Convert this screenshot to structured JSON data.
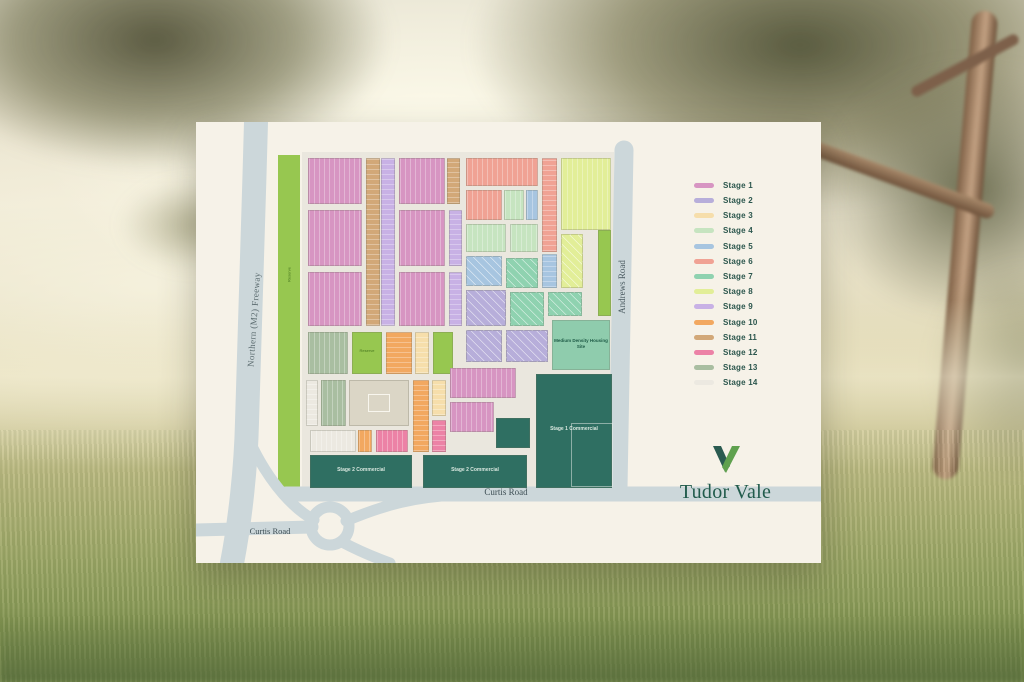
{
  "legend": {
    "items": [
      {
        "key": "s1",
        "label": "Stage 1",
        "color": "#D795C2"
      },
      {
        "key": "s2",
        "label": "Stage 2",
        "color": "#B7AEDA"
      },
      {
        "key": "s3",
        "label": "Stage 3",
        "color": "#F6DEAB"
      },
      {
        "key": "s4",
        "label": "Stage 4",
        "color": "#C6E4C0"
      },
      {
        "key": "s5",
        "label": "Stage 5",
        "color": "#A7C5E0"
      },
      {
        "key": "s6",
        "label": "Stage 6",
        "color": "#F0A294"
      },
      {
        "key": "s7",
        "label": "Stage 7",
        "color": "#8FD2B0"
      },
      {
        "key": "s8",
        "label": "Stage 8",
        "color": "#E2EE98"
      },
      {
        "key": "s9",
        "label": "Stage 9",
        "color": "#C8B1E5"
      },
      {
        "key": "s10",
        "label": "Stage 10",
        "color": "#F2A860"
      },
      {
        "key": "s11",
        "label": "Stage 11",
        "color": "#D2A878"
      },
      {
        "key": "s12",
        "label": "Stage 12",
        "color": "#EC82A6"
      },
      {
        "key": "s13",
        "label": "Stage 13",
        "color": "#A9BEA1"
      },
      {
        "key": "s14",
        "label": "Stage 14",
        "color": "#ECE9E1"
      }
    ]
  },
  "logo": {
    "wordmark": "Tudor Vale",
    "icon_dark": "#2A5B50",
    "icon_green": "#5FA14E"
  },
  "map": {
    "labels": {
      "freeway": "Northern (M2) Freeway",
      "andrews": "Andrews Road",
      "curtis": "Curtis Road",
      "curtis_west": "Curtis Road",
      "reserve": "Reserve",
      "reserve_2": "Reserve",
      "medium_density": "Medium Density Housing Site",
      "stage1_commercial": "Stage 1 Commercial",
      "stage2_commercial_a": "Stage 2 Commercial",
      "stage2_commercial_b": "Stage 2 Commercial"
    },
    "palette": {
      "s1": "#D795C2",
      "s2": "#B7AEDA",
      "s3": "#F6DEAB",
      "s4": "#C6E4C0",
      "s5": "#A7C5E0",
      "s6": "#F0A294",
      "s7": "#8FD2B0",
      "s8": "#E2EE98",
      "s9": "#C8B1E5",
      "s10": "#F2A860",
      "s11": "#D2A878",
      "s12": "#EC82A6",
      "s13": "#A9BEA1",
      "s14": "#ECE9E1",
      "park": "#97C750",
      "comm": "#2F6F62",
      "md": "#8FCCAD",
      "bldg": "#DBD6C6",
      "road": "#CCD7DA",
      "inner_road": "#EAE7DE",
      "card": "#F6F2E8"
    },
    "blocks": [
      {
        "s": "s1",
        "x": 112,
        "y": 36,
        "w": 54,
        "h": 46,
        "d": "v"
      },
      {
        "s": "s1",
        "x": 112,
        "y": 88,
        "w": 54,
        "h": 56,
        "d": "v"
      },
      {
        "s": "s1",
        "x": 112,
        "y": 150,
        "w": 54,
        "h": 54,
        "d": "v"
      },
      {
        "s": "s11",
        "x": 170,
        "y": 36,
        "w": 14,
        "h": 168,
        "d": "h"
      },
      {
        "s": "s9",
        "x": 185,
        "y": 36,
        "w": 14,
        "h": 168,
        "d": "h"
      },
      {
        "s": "s1",
        "x": 203,
        "y": 36,
        "w": 46,
        "h": 46,
        "d": "v"
      },
      {
        "s": "s11",
        "x": 251,
        "y": 36,
        "w": 13,
        "h": 46,
        "d": "h"
      },
      {
        "s": "s1",
        "x": 203,
        "y": 88,
        "w": 46,
        "h": 56,
        "d": "v"
      },
      {
        "s": "s1",
        "x": 203,
        "y": 150,
        "w": 46,
        "h": 54,
        "d": "v"
      },
      {
        "s": "s9",
        "x": 253,
        "y": 88,
        "w": 13,
        "h": 56,
        "d": "h"
      },
      {
        "s": "s9",
        "x": 253,
        "y": 150,
        "w": 13,
        "h": 54,
        "d": "h"
      },
      {
        "s": "s6",
        "x": 270,
        "y": 36,
        "w": 72,
        "h": 28,
        "d": "v"
      },
      {
        "s": "s6",
        "x": 270,
        "y": 68,
        "w": 36,
        "h": 30,
        "d": "v"
      },
      {
        "s": "s4",
        "x": 308,
        "y": 68,
        "w": 20,
        "h": 30,
        "d": "v"
      },
      {
        "s": "s5",
        "x": 330,
        "y": 68,
        "w": 12,
        "h": 30,
        "d": "v"
      },
      {
        "s": "s4",
        "x": 270,
        "y": 102,
        "w": 40,
        "h": 28,
        "d": "v"
      },
      {
        "s": "s4",
        "x": 314,
        "y": 102,
        "w": 28,
        "h": 28,
        "d": "v"
      },
      {
        "s": "s6",
        "x": 346,
        "y": 36,
        "w": 15,
        "h": 94,
        "d": "h"
      },
      {
        "s": "s5",
        "x": 346,
        "y": 132,
        "w": 15,
        "h": 34,
        "d": "h"
      },
      {
        "s": "s8",
        "x": 365,
        "y": 36,
        "w": 50,
        "h": 72,
        "d": "v"
      },
      {
        "s": "s8",
        "x": 365,
        "y": 112,
        "w": 22,
        "h": 54,
        "d": "d"
      },
      {
        "s": "park",
        "x": 402,
        "y": 108,
        "w": 13,
        "h": 86
      },
      {
        "s": "s5",
        "x": 270,
        "y": 134,
        "w": 36,
        "h": 30,
        "d": "d"
      },
      {
        "s": "s2",
        "x": 270,
        "y": 168,
        "w": 40,
        "h": 36,
        "d": "d"
      },
      {
        "s": "s7",
        "x": 310,
        "y": 136,
        "w": 32,
        "h": 30,
        "d": "d"
      },
      {
        "s": "s7",
        "x": 314,
        "y": 170,
        "w": 34,
        "h": 34,
        "d": "d"
      },
      {
        "s": "s7",
        "x": 352,
        "y": 170,
        "w": 34,
        "h": 24,
        "d": "d"
      },
      {
        "s": "s2",
        "x": 270,
        "y": 208,
        "w": 36,
        "h": 32,
        "d": "d"
      },
      {
        "s": "s2",
        "x": 310,
        "y": 208,
        "w": 42,
        "h": 32,
        "d": "d"
      },
      {
        "s": "s13",
        "x": 112,
        "y": 210,
        "w": 40,
        "h": 42,
        "d": "v"
      },
      {
        "s": "park",
        "x": 156,
        "y": 210,
        "w": 30,
        "h": 42
      },
      {
        "s": "s10",
        "x": 190,
        "y": 210,
        "w": 26,
        "h": 42,
        "d": "h"
      },
      {
        "s": "s3",
        "x": 219,
        "y": 210,
        "w": 14,
        "h": 42,
        "d": "h"
      },
      {
        "s": "park",
        "x": 237,
        "y": 210,
        "w": 20,
        "h": 42
      },
      {
        "s": "s14",
        "x": 110,
        "y": 258,
        "w": 12,
        "h": 46,
        "d": "h"
      },
      {
        "s": "s13",
        "x": 125,
        "y": 258,
        "w": 25,
        "h": 46,
        "d": "v"
      },
      {
        "s": "bldg",
        "x": 153,
        "y": 258,
        "w": 60,
        "h": 46,
        "fp": true
      },
      {
        "s": "s10",
        "x": 217,
        "y": 258,
        "w": 16,
        "h": 72,
        "d": "h"
      },
      {
        "s": "s3",
        "x": 236,
        "y": 258,
        "w": 14,
        "h": 36,
        "d": "h"
      },
      {
        "s": "s12",
        "x": 236,
        "y": 298,
        "w": 14,
        "h": 32,
        "d": "h"
      },
      {
        "s": "s14",
        "x": 114,
        "y": 308,
        "w": 46,
        "h": 22,
        "d": "v"
      },
      {
        "s": "s10",
        "x": 162,
        "y": 308,
        "w": 14,
        "h": 22,
        "d": "v"
      },
      {
        "s": "s12",
        "x": 180,
        "y": 308,
        "w": 32,
        "h": 22,
        "d": "v"
      },
      {
        "s": "s1",
        "x": 254,
        "y": 246,
        "w": 66,
        "h": 30,
        "d": "v"
      },
      {
        "s": "s1",
        "x": 254,
        "y": 280,
        "w": 44,
        "h": 30,
        "d": "v"
      },
      {
        "s": "md",
        "x": 356,
        "y": 198,
        "w": 58,
        "h": 50,
        "label": "medium_density"
      },
      {
        "s": "comm",
        "x": 340,
        "y": 252,
        "w": 76,
        "h": 114,
        "label": "stage1_commercial",
        "inner": [
          34,
          48,
          40,
          62
        ]
      },
      {
        "s": "comm",
        "x": 300,
        "y": 296,
        "w": 34,
        "h": 30
      },
      {
        "s": "comm",
        "x": 114,
        "y": 333,
        "w": 102,
        "h": 33,
        "label": "stage2_commercial_a"
      },
      {
        "s": "comm",
        "x": 227,
        "y": 333,
        "w": 104,
        "h": 33,
        "label": "stage2_commercial_b"
      }
    ]
  }
}
